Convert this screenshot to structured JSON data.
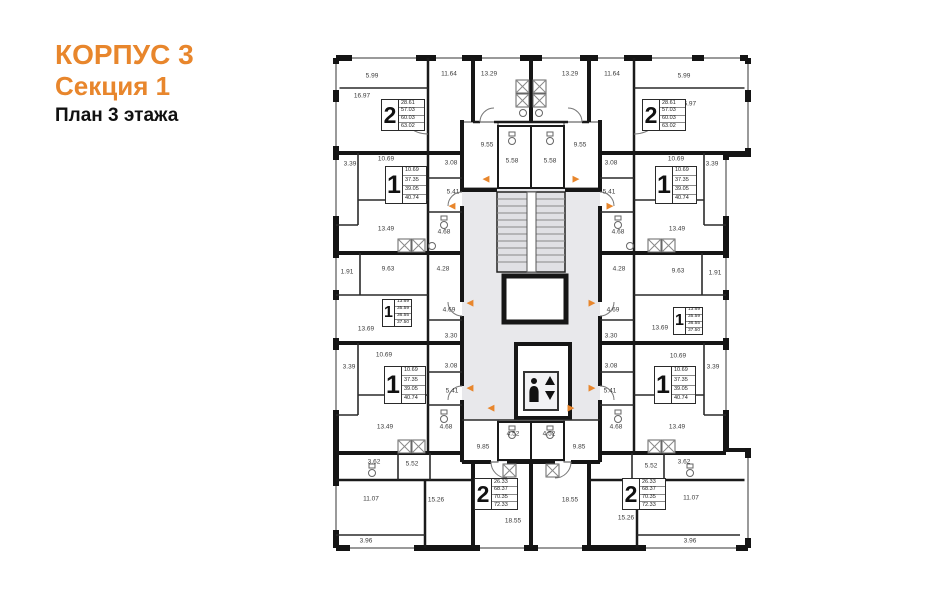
{
  "header": {
    "building": "КОРПУС 3",
    "section": "Секция 1",
    "floor_plan": "План 3 этажа"
  },
  "colors": {
    "accent": "#E8862C",
    "wall": "#141414",
    "common_area": "#E8E8EB"
  },
  "icons": {
    "elevator": "elevator-person-updown-icon",
    "entry_arrow": "entry-direction-arrow-icon"
  },
  "arrow_glyphs": {
    "l": "◀",
    "r": "▶"
  },
  "apartments": [
    {
      "id": "2room-top-left",
      "type": "2",
      "areas": [
        "28.61",
        "57.03",
        "60.03",
        "63.02"
      ]
    },
    {
      "id": "2room-top-right",
      "type": "2",
      "areas": [
        "28.61",
        "57.03",
        "60.03",
        "63.02"
      ]
    },
    {
      "id": "1room-upper-left",
      "type": "1",
      "areas": [
        "10.69",
        "37.35",
        "39.05",
        "40.74"
      ]
    },
    {
      "id": "1room-upper-right",
      "type": "1",
      "areas": [
        "10.69",
        "37.35",
        "39.05",
        "40.74"
      ]
    },
    {
      "id": "1room-middle-left",
      "type": "1",
      "areas": [
        "13.69",
        "35.59",
        "36.55",
        "37.50"
      ]
    },
    {
      "id": "1room-middle-right",
      "type": "1",
      "areas": [
        "13.69",
        "35.59",
        "36.55",
        "37.50"
      ]
    },
    {
      "id": "1room-lower-left",
      "type": "1",
      "areas": [
        "10.69",
        "37.35",
        "39.05",
        "40.74"
      ]
    },
    {
      "id": "1room-lower-right",
      "type": "1",
      "areas": [
        "10.69",
        "37.35",
        "39.05",
        "40.74"
      ]
    },
    {
      "id": "2room-bottom-left",
      "type": "2",
      "areas": [
        "26.33",
        "68.37",
        "70.35",
        "72.33"
      ]
    },
    {
      "id": "2room-bottom-right",
      "type": "2",
      "areas": [
        "26.33",
        "68.37",
        "70.35",
        "72.33"
      ]
    }
  ],
  "area_labels": [
    {
      "x": 372,
      "y": 76,
      "t": "5.99"
    },
    {
      "x": 449,
      "y": 74,
      "t": "11.64"
    },
    {
      "x": 489,
      "y": 74,
      "t": "13.29"
    },
    {
      "x": 570,
      "y": 74,
      "t": "13.29"
    },
    {
      "x": 612,
      "y": 74,
      "t": "11.64"
    },
    {
      "x": 684,
      "y": 76,
      "t": "5.99"
    },
    {
      "x": 362,
      "y": 96,
      "t": "16.97"
    },
    {
      "x": 688,
      "y": 104,
      "t": "16.97"
    },
    {
      "x": 487,
      "y": 145,
      "t": "9.55"
    },
    {
      "x": 580,
      "y": 145,
      "t": "9.55"
    },
    {
      "x": 512,
      "y": 161,
      "t": "5.58"
    },
    {
      "x": 550,
      "y": 161,
      "t": "5.58"
    },
    {
      "x": 350,
      "y": 164,
      "t": "3.39"
    },
    {
      "x": 386,
      "y": 159,
      "t": "10.69"
    },
    {
      "x": 676,
      "y": 159,
      "t": "10.69"
    },
    {
      "x": 712,
      "y": 164,
      "t": "3.39"
    },
    {
      "x": 451,
      "y": 163,
      "t": "3.08"
    },
    {
      "x": 611,
      "y": 163,
      "t": "3.08"
    },
    {
      "x": 453,
      "y": 192,
      "t": "5.41"
    },
    {
      "x": 609,
      "y": 192,
      "t": "5.41"
    },
    {
      "x": 386,
      "y": 229,
      "t": "13.49"
    },
    {
      "x": 677,
      "y": 229,
      "t": "13.49"
    },
    {
      "x": 444,
      "y": 232,
      "t": "4.68"
    },
    {
      "x": 618,
      "y": 232,
      "t": "4.68"
    },
    {
      "x": 347,
      "y": 272,
      "t": "1.91"
    },
    {
      "x": 715,
      "y": 273,
      "t": "1.91"
    },
    {
      "x": 388,
      "y": 269,
      "t": "9.63"
    },
    {
      "x": 678,
      "y": 271,
      "t": "9.63"
    },
    {
      "x": 443,
      "y": 269,
      "t": "4.28"
    },
    {
      "x": 619,
      "y": 269,
      "t": "4.28"
    },
    {
      "x": 366,
      "y": 329,
      "t": "13.69"
    },
    {
      "x": 660,
      "y": 328,
      "t": "13.69"
    },
    {
      "x": 449,
      "y": 310,
      "t": "4.69"
    },
    {
      "x": 613,
      "y": 310,
      "t": "4.69"
    },
    {
      "x": 451,
      "y": 336,
      "t": "3.30"
    },
    {
      "x": 611,
      "y": 336,
      "t": "3.30"
    },
    {
      "x": 384,
      "y": 355,
      "t": "10.69"
    },
    {
      "x": 678,
      "y": 356,
      "t": "10.69"
    },
    {
      "x": 349,
      "y": 367,
      "t": "3.39"
    },
    {
      "x": 713,
      "y": 367,
      "t": "3.39"
    },
    {
      "x": 451,
      "y": 366,
      "t": "3.08"
    },
    {
      "x": 611,
      "y": 366,
      "t": "3.08"
    },
    {
      "x": 452,
      "y": 391,
      "t": "5.41"
    },
    {
      "x": 610,
      "y": 391,
      "t": "5.41"
    },
    {
      "x": 385,
      "y": 427,
      "t": "13.49"
    },
    {
      "x": 677,
      "y": 427,
      "t": "13.49"
    },
    {
      "x": 446,
      "y": 427,
      "t": "4.68"
    },
    {
      "x": 616,
      "y": 427,
      "t": "4.68"
    },
    {
      "x": 513,
      "y": 434,
      "t": "4.52"
    },
    {
      "x": 549,
      "y": 434,
      "t": "4.52"
    },
    {
      "x": 483,
      "y": 447,
      "t": "9.85"
    },
    {
      "x": 579,
      "y": 447,
      "t": "9.85"
    },
    {
      "x": 374,
      "y": 462,
      "t": "3.62"
    },
    {
      "x": 684,
      "y": 462,
      "t": "3.62"
    },
    {
      "x": 412,
      "y": 464,
      "t": "5.52"
    },
    {
      "x": 651,
      "y": 466,
      "t": "5.52"
    },
    {
      "x": 371,
      "y": 499,
      "t": "11.07"
    },
    {
      "x": 691,
      "y": 498,
      "t": "11.07"
    },
    {
      "x": 436,
      "y": 500,
      "t": "15.26"
    },
    {
      "x": 626,
      "y": 518,
      "t": "15.26"
    },
    {
      "x": 513,
      "y": 521,
      "t": "18.55"
    },
    {
      "x": 570,
      "y": 500,
      "t": "18.55"
    },
    {
      "x": 366,
      "y": 541,
      "t": "3.96"
    },
    {
      "x": 690,
      "y": 541,
      "t": "3.96"
    }
  ],
  "arrows": [
    {
      "x": 486,
      "y": 179,
      "d": "l"
    },
    {
      "x": 576,
      "y": 179,
      "d": "r"
    },
    {
      "x": 452,
      "y": 206,
      "d": "l"
    },
    {
      "x": 610,
      "y": 206,
      "d": "r"
    },
    {
      "x": 470,
      "y": 303,
      "d": "l"
    },
    {
      "x": 592,
      "y": 303,
      "d": "r"
    },
    {
      "x": 470,
      "y": 388,
      "d": "l"
    },
    {
      "x": 592,
      "y": 388,
      "d": "r"
    },
    {
      "x": 491,
      "y": 408,
      "d": "l"
    },
    {
      "x": 571,
      "y": 408,
      "d": "r"
    }
  ]
}
